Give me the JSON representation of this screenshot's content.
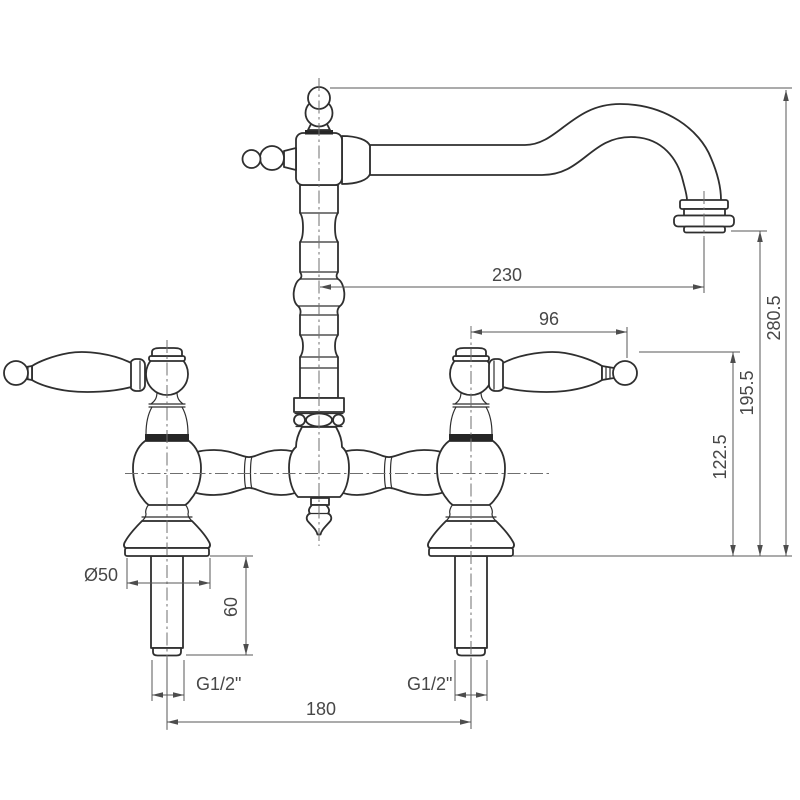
{
  "drawing": {
    "kind": "technical dimension drawing",
    "subject": "two-handle bridge faucet, front elevation",
    "background": "#ffffff",
    "object_line_color": "#2f2f2f",
    "dimension_line_color": "#575757",
    "text_color": "#474747",
    "labels": {
      "spout_reach": "230",
      "overall_height": "280.5",
      "handle_length": "96",
      "outlet_height": "195.5",
      "handle_height": "122.5",
      "base_diameter": "Ø50",
      "shank_length": "60",
      "thread_left": "G1/2\"",
      "thread_right": "G1/2\"",
      "hole_spacing": "180"
    }
  }
}
